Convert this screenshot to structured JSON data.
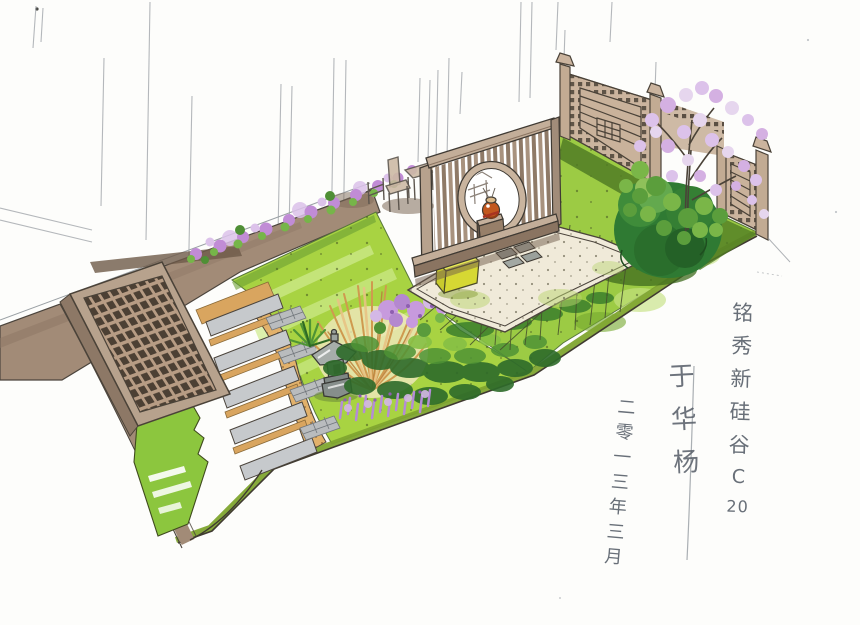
{
  "inscription": {
    "title": {
      "text": "铭秀新硅谷 C 20",
      "chars": [
        "铭",
        "秀",
        "新",
        "硅",
        "谷",
        "C",
        "20"
      ]
    },
    "signature": {
      "text": "于华杨",
      "chars": [
        "于",
        "华",
        "杨"
      ]
    },
    "date": {
      "text": "二零一三年三月",
      "chars": [
        "二",
        "零",
        "一",
        "三",
        "年",
        "三",
        "月"
      ]
    }
  },
  "palette": {
    "paper": "#fdfdfb",
    "lawn_bright": "#a8d342",
    "lawn_right": "#9ccb44",
    "lawn_highlight": "#cdea8c",
    "lawn_edge_olive": "#7fa52f",
    "path_taupe": "#a28b77",
    "wood_light": "#c3ae99",
    "wood_dark": "#8a7461",
    "fence_tan": "#cbb49e",
    "gravel_tan": "#e2b16b",
    "paver_gray": "#c6c9cc",
    "shrub_green": "#2f7a33",
    "leaf_green": "#76b549",
    "flower_purple": "#c18cd6",
    "blossom_pink": "#dcc2ea",
    "grass_gold": "#cf9a4f",
    "cushion_yellow": "#eaec55",
    "vase_orange": "#c2581f",
    "lantern_gray": "#8d9591",
    "ink_line": "#3f3a33",
    "pencil_gray": "#8e9399"
  }
}
